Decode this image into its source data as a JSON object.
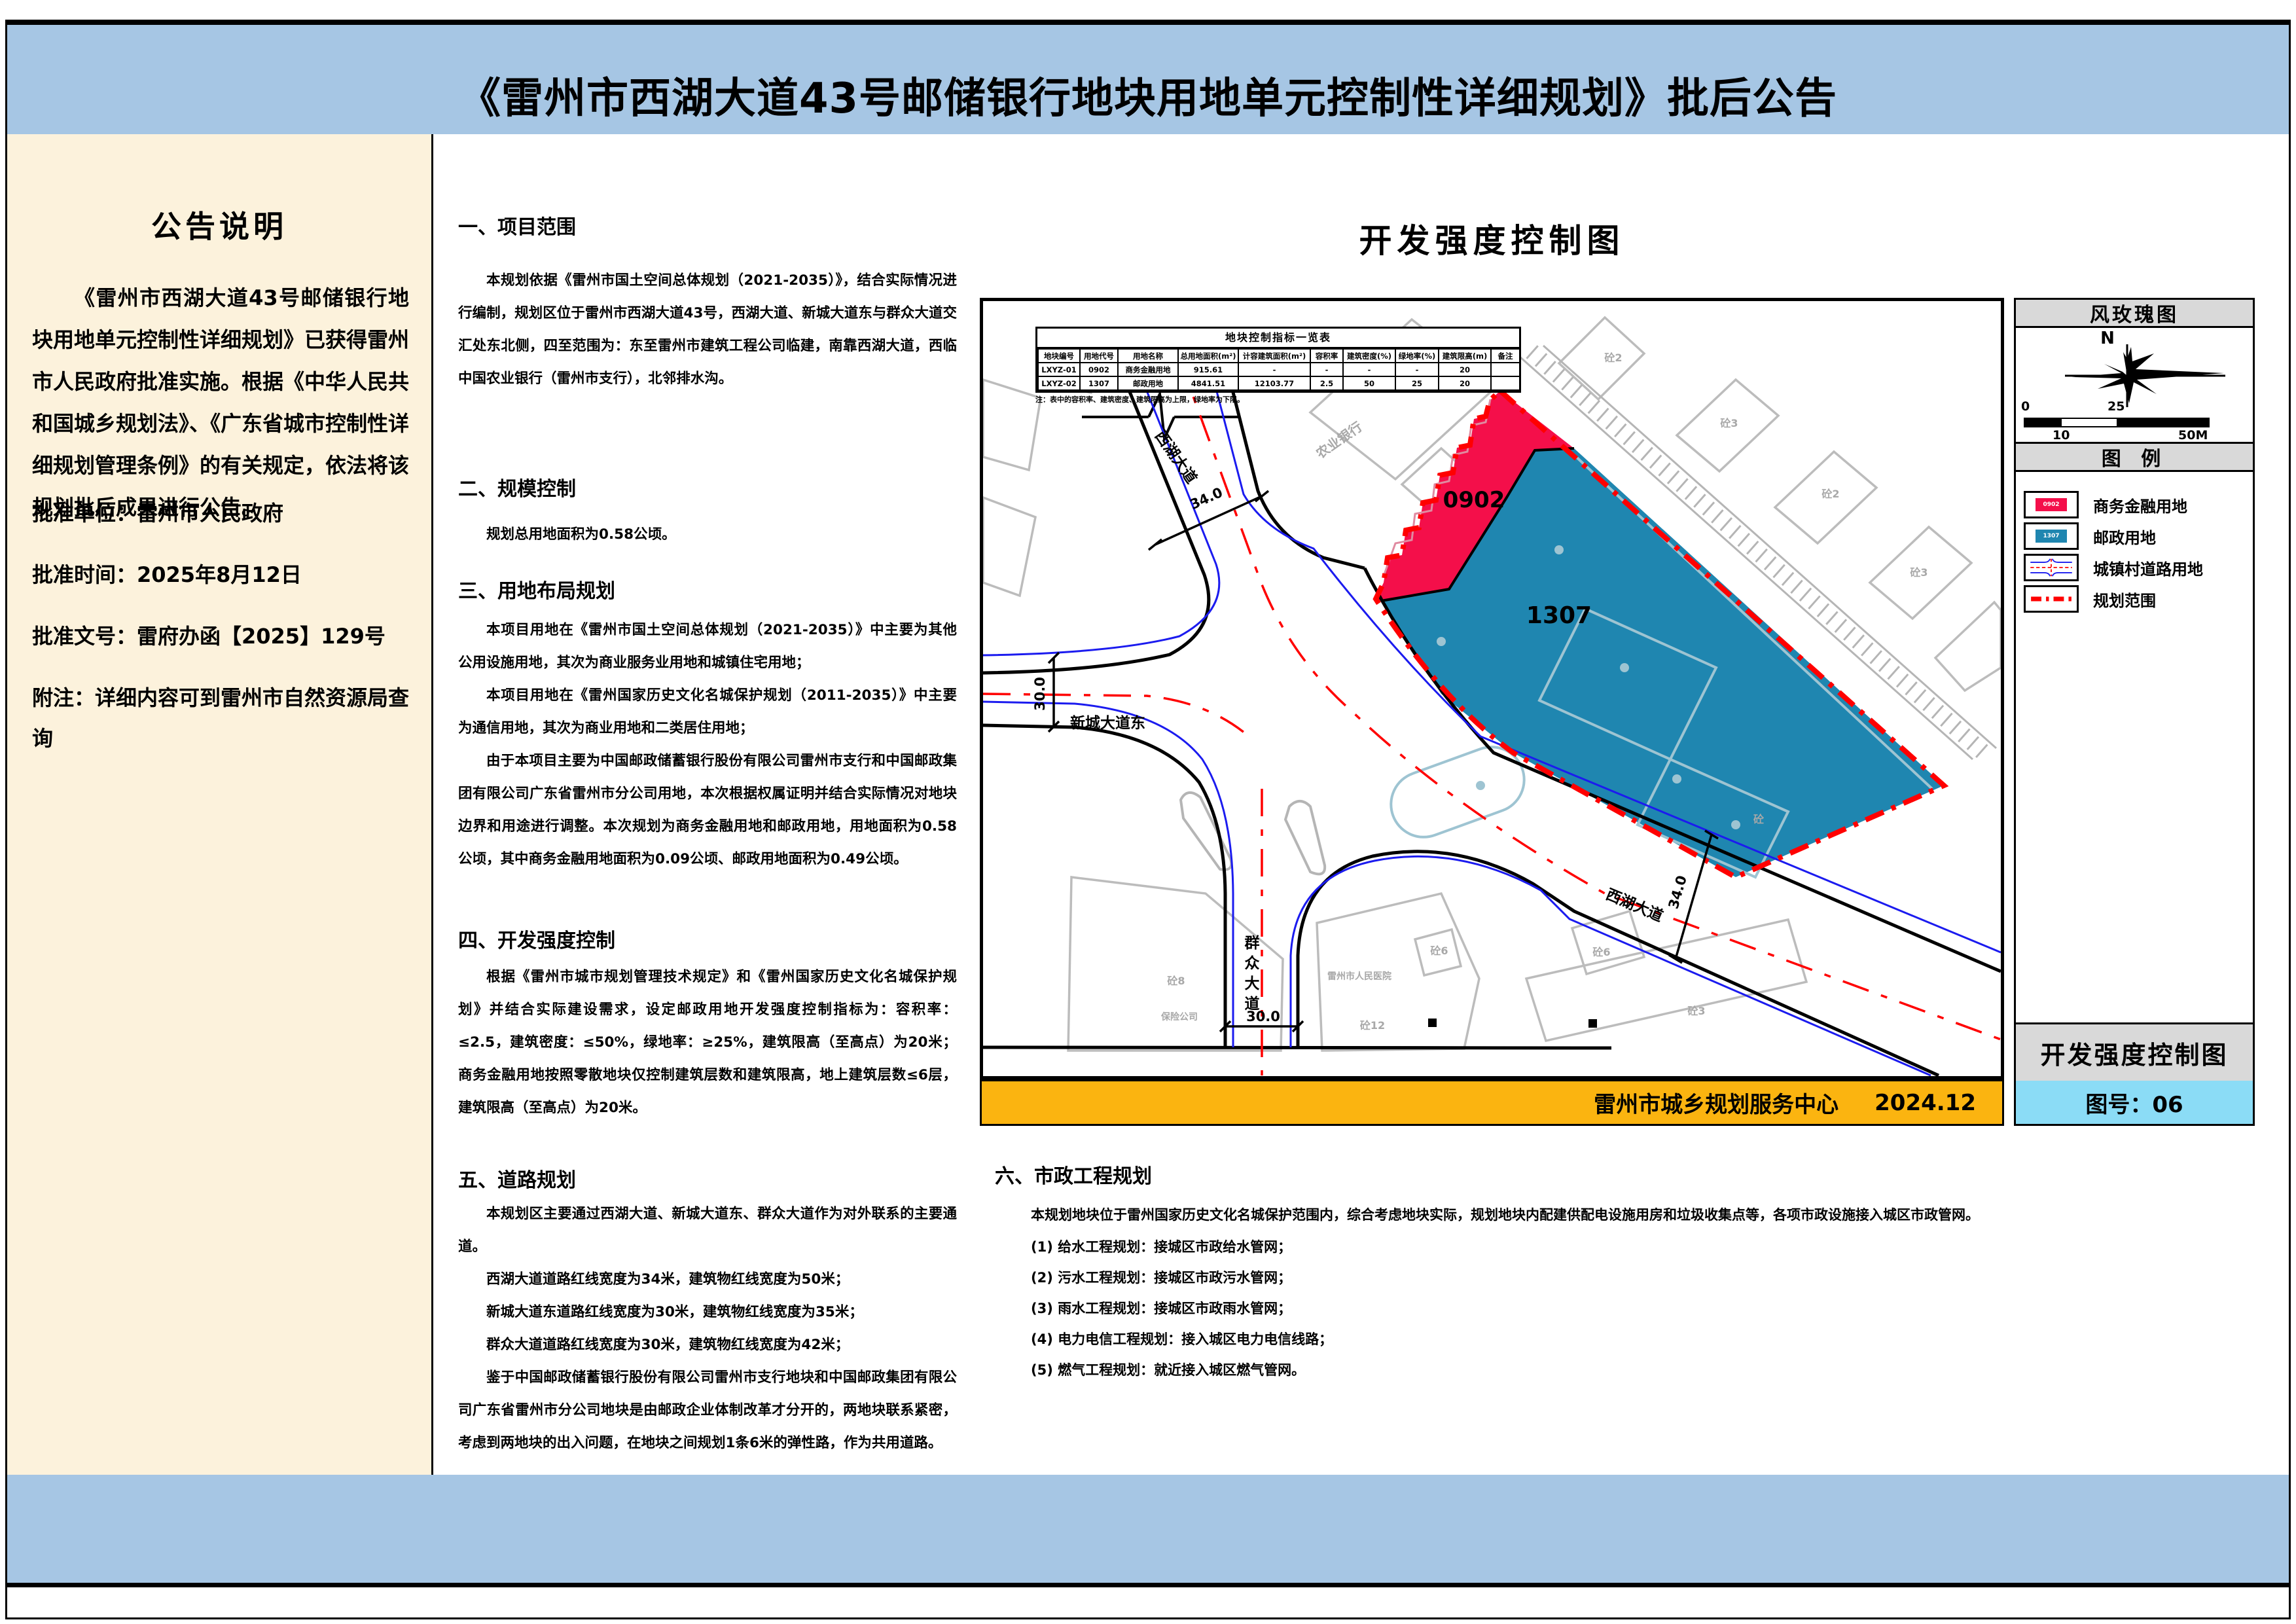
{
  "page": {
    "title": "《雷州市西湖大道43号邮储银行地块用地单元控制性详细规划》批后公告"
  },
  "notice": {
    "title": "公告说明",
    "paragraph": "《雷州市西湖大道43号邮储银行地块用地单元控制性详细规划》已获得雷州市人民政府批准实施。根据《中华人民共和国城乡规划法》、《广东省城市控制性详细规划管理条例》的有关规定，依法将该规划批后成果进行公告。",
    "items": [
      "批准单位：雷州市人民政府",
      "批准时间：2025年8月12日",
      "批准文号：雷府办函【2025】129号",
      "附注：详细内容可到雷州市自然资源局查询"
    ]
  },
  "sections": [
    {
      "heading": "一、项目范围",
      "paragraphs": [
        "本规划依据《雷州市国土空间总体规划（2021-2035）》，结合实际情况进行编制，规划区位于雷州市西湖大道43号，西湖大道、新城大道东与群众大道交汇处东北侧，四至范围为：东至雷州市建筑工程公司临建，南靠西湖大道，西临中国农业银行（雷州市支行），北邻排水沟。"
      ]
    },
    {
      "heading": "二、规模控制",
      "paragraphs": [
        "规划总用地面积为0.58公顷。"
      ]
    },
    {
      "heading": "三、用地布局规划",
      "paragraphs": [
        "本项目用地在《雷州市国土空间总体规划（2021-2035）》中主要为其他公用设施用地，其次为商业服务业用地和城镇住宅用地；",
        "本项目用地在《雷州国家历史文化名城保护规划（2011-2035）》中主要为通信用地，其次为商业用地和二类居住用地；",
        "由于本项目主要为中国邮政储蓄银行股份有限公司雷州市支行和中国邮政集团有限公司广东省雷州市分公司用地，本次根据权属证明并结合实际情况对地块边界和用途进行调整。本次规划为商务金融用地和邮政用地，用地面积为0.58公顷，其中商务金融用地面积为0.09公顷、邮政用地面积为0.49公顷。"
      ]
    },
    {
      "heading": "四、开发强度控制",
      "paragraphs": [
        "根据《雷州市城市规划管理技术规定》和《雷州国家历史文化名城保护规划》并结合实际建设需求，设定邮政用地开发强度控制指标为：容积率：≤2.5，建筑密度：≤50%，绿地率：≥25%，建筑限高（至高点）为20米；商务金融用地按照零散地块仅控制建筑层数和建筑限高，地上建筑层数≤6层，建筑限高（至高点）为20米。"
      ]
    },
    {
      "heading": "五、道路规划",
      "paragraphs": [
        "本规划区主要通过西湖大道、新城大道东、群众大道作为对外联系的主要通道。",
        "西湖大道道路红线宽度为34米，建筑物红线宽度为50米；",
        "新城大道东道路红线宽度为30米，建筑物红线宽度为35米；",
        "群众大道道路红线宽度为30米，建筑物红线宽度为42米；",
        "鉴于中国邮政储蓄银行股份有限公司雷州市支行地块和中国邮政集团有限公司广东省雷州市分公司地块是由邮政企业体制改革才分开的，两地块联系紧密，考虑到两地块的出入问题，在地块之间规划1条6米的弹性路，作为共用道路。"
      ]
    }
  ],
  "section6": {
    "heading": "六、市政工程规划",
    "intro": "本规划地块位于雷州国家历史文化名城保护范围内，综合考虑地块实际，规划地块内配建供配电设施用房和垃圾收集点等，各项市政设施接入城区市政管网。",
    "items": [
      "(1) 给水工程规划：接城区市政给水管网；",
      "(2) 污水工程规划：接城区市政污水管网；",
      "(3) 雨水工程规划：接城区市政雨水管网；",
      "(4) 电力电信工程规划：接入城区电力电信线路；",
      "(5) 燃气工程规划：就近接入城区燃气管网。"
    ]
  },
  "map": {
    "title": "开发强度控制图",
    "table": {
      "title": "地块控制指标一览表",
      "headers": [
        "地块编号",
        "用地代号",
        "用地名称",
        "总用地面积(m²)",
        "计容建筑面积(m²)",
        "容积率",
        "建筑密度(%)",
        "绿地率(%)",
        "建筑限高(m)",
        "备注"
      ],
      "rows": [
        [
          "LXYZ-01",
          "0902",
          "商务金融用地",
          "915.61",
          "-",
          "-",
          "-",
          "-",
          "20",
          ""
        ],
        [
          "LXYZ-02",
          "1307",
          "邮政用地",
          "4841.51",
          "12103.77",
          "2.5",
          "50",
          "25",
          "20",
          ""
        ]
      ],
      "note": "注：表中的容积率、建筑密度、建筑限高为上限，绿地率为下限。"
    },
    "parcels": [
      "0902",
      "1307"
    ],
    "roads": {
      "xihu_north": "西湖大道",
      "xincheng_east": "新城大道东",
      "qunzhong": "群众大道",
      "xihu_southeast": "西湖大道"
    },
    "dimensions": {
      "xihu_north": "34.0",
      "xincheng_east": "30.0",
      "qunzhong": "30.0",
      "xihu_southeast": "34.0"
    },
    "buildings": [
      "农业银行",
      "砼2",
      "砼3",
      "砼2",
      "砼3",
      "砼",
      "砼6",
      "砼3",
      "砼6",
      "雷州市人民医院",
      "砼12",
      "砼8",
      "保险公司"
    ],
    "footer": {
      "org": "雷州市城乡规划服务中心",
      "date": "2024.12"
    }
  },
  "panel": {
    "rose_title": "风玫瑰图",
    "north": "N",
    "scale": [
      "0",
      "25",
      "10",
      "50M"
    ],
    "legend_title": "图  例",
    "legend": [
      {
        "label": "商务金融用地",
        "code": "0902"
      },
      {
        "label": "邮政用地",
        "code": "1307"
      },
      {
        "label": "城镇村道路用地",
        "code": ""
      },
      {
        "label": "规划范围",
        "code": ""
      }
    ],
    "sheet_title": "开发强度控制图",
    "sheet_no": "图号：06"
  },
  "colors": {
    "title_band": "#a6c6e4",
    "sidebar": "#fcf2dc",
    "footer_bar": "#fbb410",
    "sheet_no_band": "#8bdcf6",
    "commercial_finance": "#f40f4a",
    "postal": "#1f86b0",
    "plan_boundary": "#ff0000"
  }
}
